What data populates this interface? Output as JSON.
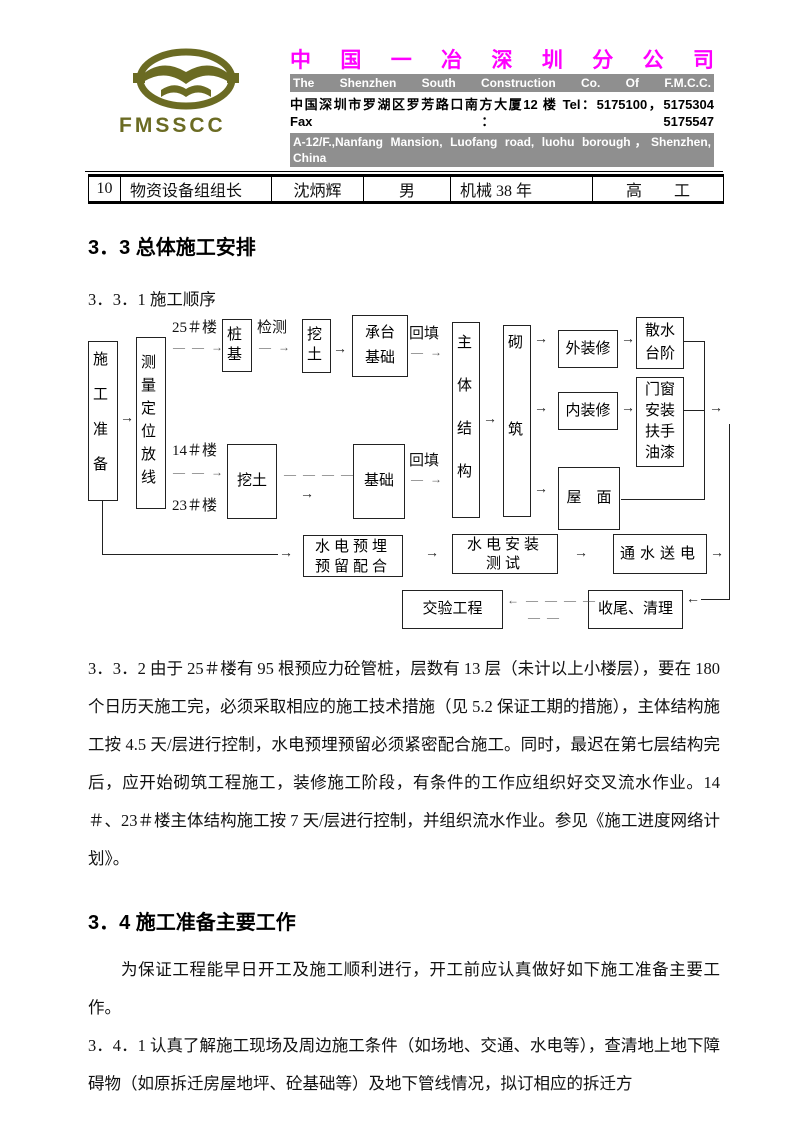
{
  "header": {
    "logo_text": "FMSSCC",
    "company_cn": "中 国 一 冶 深 圳 分 公 司",
    "company_en": "The Shenzhen South Construction Co. Of F.M.C.C.",
    "address_cn": "中国深圳市罗湖区罗芳路口南方大厦12 楼 Tel：5175100，5175304 Fax：5175547",
    "address_en": "A-12/F.,Nanfang Mansion, Luofang road, luohu borough，Shenzhen, China",
    "brand_color": "#ff00ff",
    "bar_color": "#8f8f8f",
    "logo_color": "#6b6b23"
  },
  "table": {
    "row": {
      "no": "10",
      "role": "物资设备组组长",
      "name": "沈炳辉",
      "gender": "男",
      "experience": "机械 38 年",
      "title": "高　　工"
    }
  },
  "sections": {
    "s33_heading": "3．3 总体施工安排",
    "s331_heading": "3．3．1 施工顺序",
    "s332_text": "3．3．2 由于 25＃楼有 95 根预应力砼管桩，层数有 13 层（未计以上小楼层），要在 180 个日历天施工完，必须采取相应的施工技术措施（见 5.2 保证工期的措施），主体结构施工按 4.5 天/层进行控制，水电预埋预留必须紧密配合施工。同时，最迟在第七层结构完后，应开始砌筑工程施工，装修施工阶段，有条件的工作应组织好交叉流水作业。14＃、23＃楼主体结构施工按 7 天/层进行控制，并组织流水作业。参见《施工进度网络计划》。",
    "s34_heading": "3．4 施工准备主要工作",
    "s34_intro": "为保证工程能早日开工及施工顺利进行，开工前应认真做好如下施工准备主要工作。",
    "s341_text": "3．4．1 认真了解施工现场及周边施工条件（如场地、交通、水电等），查清地上地下障碍物（如原拆迁房屋地坪、砼基础等）及地下管线情况，拟订相应的拆迁方"
  },
  "flowchart": {
    "nodes": {
      "prep": "施工准备",
      "survey": "测量定位放线",
      "pile": "桩基",
      "dig1": "挖土",
      "cap": "承台基础",
      "main": "主体结构",
      "masonry": "砌筑",
      "ext": "外装修",
      "apron": "散水台阶",
      "int": "内装修",
      "doors": "门窗安装扶手油漆",
      "roof": "屋　面",
      "dig2": "挖土",
      "found": "基础",
      "embed": "水电预埋预留配合",
      "install": "水电安装测试",
      "power": "通水送电",
      "cleanup": "收尾、清理",
      "handover": "交验工程"
    },
    "labels": {
      "b25": "25＃楼",
      "b14": "14＃楼",
      "b23": "23＃楼",
      "inspect": "检测",
      "backfill1": "回填",
      "backfill2": "回填"
    },
    "glyphs": {
      "arrow_right": "→",
      "arrow_left": "←",
      "dash1_arrow": "— →",
      "dash2_arrow": "— — →",
      "dash4": "— — — —",
      "dash4_arrow_left": "← — — — —",
      "dash2": "— —"
    }
  }
}
